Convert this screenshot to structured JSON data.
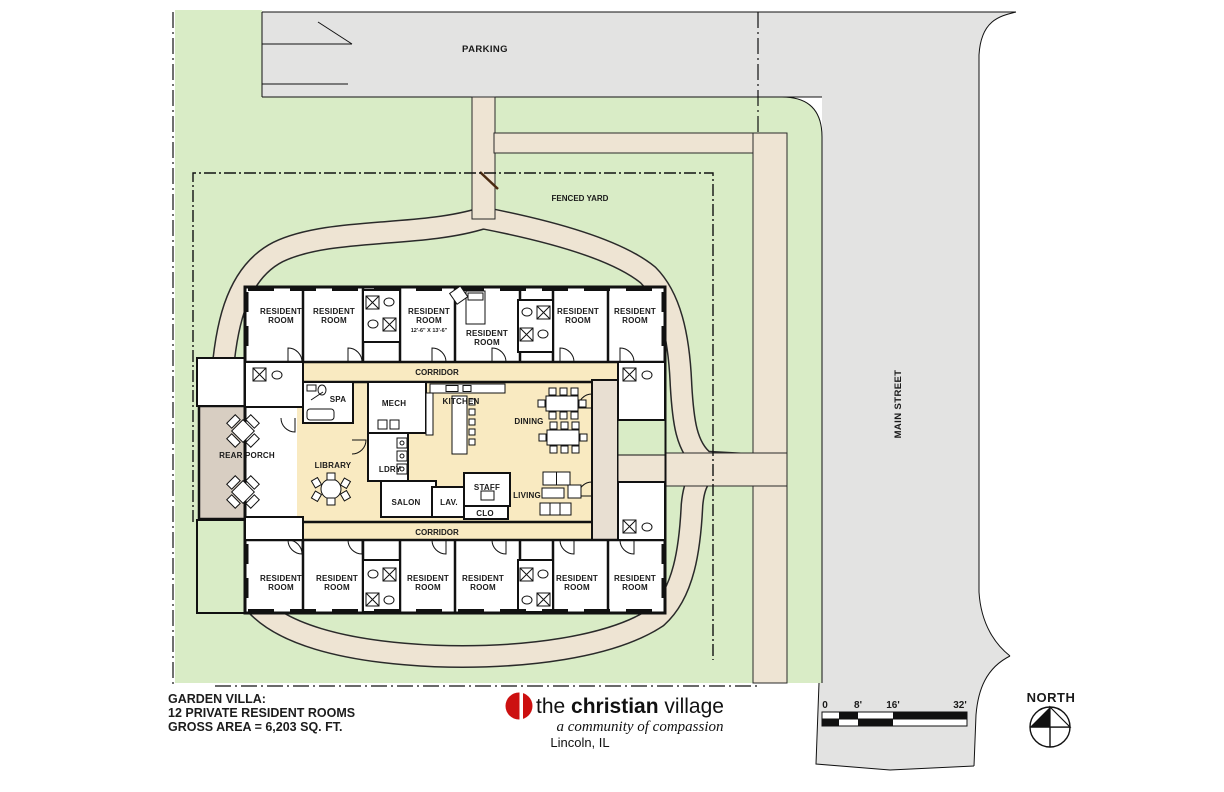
{
  "site": {
    "parking_label": "PARKING",
    "fenced_yard_label": "FENCED YARD",
    "main_street_label": "MAIN STREET",
    "entry_label": "ENTRY"
  },
  "building": {
    "corridor_label": "CORRIDOR",
    "resident_room_line1": "RESIDENT",
    "resident_room_line2": "ROOM",
    "room_dimension": "12'-6\" X 13'-6\"",
    "spa": "SPA",
    "mech": "MECH",
    "kitchen": "KITCHEN",
    "dining": "DINING",
    "library": "LIBRARY",
    "ldry": "LDRY",
    "salon": "SALON",
    "lav": "LAV.",
    "staff": "STAFF",
    "clo": "CLO",
    "living": "LIVING",
    "rear_porch": "REAR PORCH"
  },
  "title_block": {
    "line1": "GARDEN VILLA:",
    "line2": "12 PRIVATE RESIDENT ROOMS",
    "line3": "GROSS AREA = 6,203 SQ. FT."
  },
  "logo": {
    "word1": "the ",
    "word2": "christian",
    "word3": " village",
    "tagline": "a community of compassion",
    "city": "Lincoln, IL"
  },
  "scale_bar": {
    "labels": [
      "0",
      "8'",
      "16'",
      "32'"
    ]
  },
  "compass": {
    "label": "NORTH"
  },
  "colors": {
    "site_green": "#d9ecc6",
    "street_gray": "#e3e3e2",
    "walk_tan": "#eee4d3",
    "common_yellow": "#f9eac1",
    "porch_tan": "#d8cec2",
    "logo_red": "#cc1010"
  }
}
